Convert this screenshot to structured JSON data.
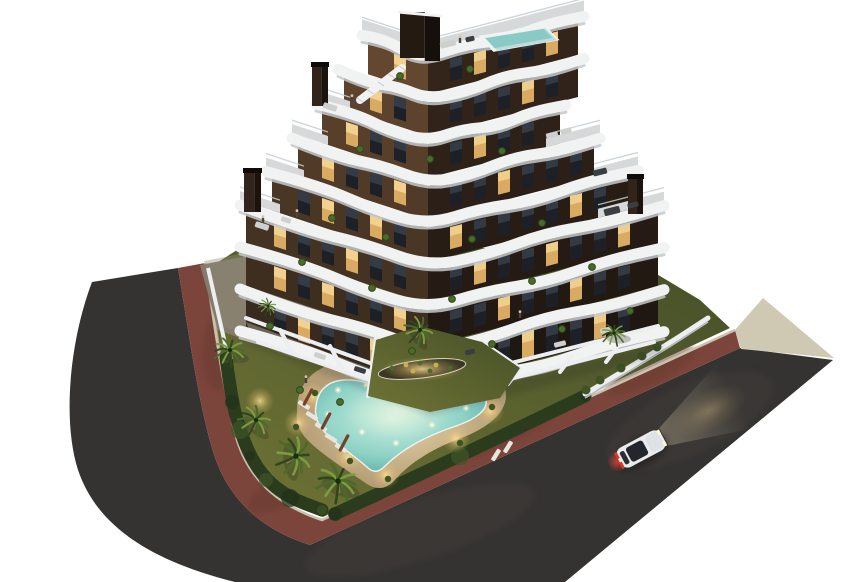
{
  "meta": {
    "kind": "architectural-dusk-render",
    "canvas": {
      "w": 850,
      "h": 582
    },
    "background": "#ffffff"
  },
  "palette": {
    "asphalt": "#353331",
    "asphalt_light": "#45413c",
    "road_edge": "#24221f",
    "bike": "#7c453b",
    "bike_dark": "#693a32",
    "curb": "#cbc2ae",
    "pale": "#cfc8b2",
    "lawn_light": "#6f7435",
    "lawn_dark": "#454f28",
    "hedge": "#2b3c1e",
    "hedge_dark": "#22311a",
    "hedge_light": "#3e5426",
    "deck_light": "#e2cfa6",
    "deck_dark": "#b49d75",
    "pool_light": "#c9efe0",
    "pool_mid": "#8fd2c6",
    "pool_deep": "#4f9f9b",
    "pool_rim": "#eaf5f0",
    "shrub": "#3f5524",
    "palm_dark": "#2e481c",
    "palm_mid": "#4b6b2a",
    "palm_light": "#7b9c42",
    "trunk": "#8a775a",
    "facade_l_top": "#63472f",
    "facade_l_bot": "#382a1e",
    "facade_r_top": "#34251a",
    "facade_r_bot": "#1f1712",
    "band": "#f1f2f2",
    "band_shadow": "#c6c9cb",
    "roof_deck": "#d6d8d9",
    "railing": "#c2cdd2",
    "win_dark": "#1d2026",
    "win_sheen": "#39414b",
    "win_lit": "#d9ab62",
    "win_lit_core": "#f4d795",
    "wall": "#eceeef",
    "wall_shade": "#b9bdbf",
    "terr_floor": "#6e695c",
    "chimney_face": "#33241b",
    "chimney_side": "#1c130d",
    "chimney_top": "#0f0b08",
    "bulk_face": "#241a12",
    "bulk_side": "#15100b",
    "roof_pool": "#9bd6d2",
    "roof_pool_deep": "#6fb8b4",
    "car_body": "#e9ebed",
    "car_glass": "#23272d",
    "car_tail": "#d8382a",
    "beam": "#f8e9c0",
    "shadow": "#1c1d22",
    "furn_light": "#cdd0cc",
    "furn_dark": "#3a3e43",
    "paving": "#837b6b",
    "paving_light": "#948b78",
    "soil": "#3a3823"
  },
  "scene": {
    "road": {
      "asphalt_path": "M92,282 C70,340 62,420 78,470 C95,520 140,558 235,582 L565,582 L833,360 L740,348 L310,545 Q232,520 212,448 C198,400 190,340 178,268 Z",
      "bike_path": "M178,268 L205,263 C216,335 224,395 237,440 Q255,498 322,520 L735,330 L740,348 L310,545 Q232,520 212,448 C198,400 190,340 178,268 Z",
      "curb_path": "M205,263 C216,335 224,395 237,440 Q255,498 322,520 L735,330",
      "pale_wedge": "M735,330 L763,298 L834,358 L741,349 Z",
      "bike_patches": [
        [
          300,
          480,
          60,
          18,
          -30
        ],
        [
          500,
          430,
          70,
          16,
          -25
        ],
        [
          650,
          370,
          50,
          14,
          -25
        ],
        [
          220,
          350,
          18,
          40,
          5
        ]
      ],
      "sheen_spots": [
        [
          690,
          420,
          90,
          34,
          -25
        ],
        [
          420,
          530,
          120,
          30,
          -18
        ]
      ]
    },
    "property": {
      "lawn_path": "M209,268 C218,335 226,395 239,438 Q256,494 323,517 L730,328 L700,300 L650,270 L610,248 L240,248 Z",
      "paving_path": "M200,265 L268,252 L355,318 L300,360 L218,330 Z",
      "courtyard_path": "M368,396 L376,340 L420,326 L482,342 L520,368 L500,398 L430,412 Z",
      "hedge_pts_a": [
        [
          226,
          358
        ],
        [
          232,
          402
        ],
        [
          240,
          430
        ],
        [
          250,
          456
        ],
        [
          266,
          480
        ],
        [
          290,
          498
        ],
        [
          322,
          510
        ]
      ],
      "hedge_pts_b": [
        [
          335,
          514
        ],
        [
          460,
          456
        ],
        [
          585,
          396
        ]
      ],
      "wall_pts": [
        [
          585,
          394
        ],
        [
          662,
          348
        ],
        [
          708,
          318
        ]
      ],
      "left_wall": [
        208,
        268,
        226,
        348
      ],
      "bed": {
        "cx": 422,
        "cy": 369,
        "rx": 44,
        "ry": 9,
        "rot": -7
      },
      "bed_plants": [
        [
          392,
          368
        ],
        [
          406,
          365
        ],
        [
          420,
          363
        ],
        [
          436,
          365
        ],
        [
          450,
          368
        ],
        [
          413,
          371
        ],
        [
          430,
          371
        ]
      ],
      "bushes": [
        [
          600,
          380
        ],
        [
          621,
          368
        ],
        [
          642,
          356
        ],
        [
          657,
          347
        ],
        [
          586,
          390
        ]
      ]
    },
    "pool": {
      "group_offset": [
        -2,
        -9
      ],
      "deck_path": "M299,421 C298,393 316,375 344,371 C369,367 389,375 398,384 Q402,388 406,384 C418,372 442,367 462,369 C488,371 507,383 508,403 C509,421 491,436 466,446 C438,456 413,470 395,491 Q383,502 369,493 C349,479 319,461 306,445 Q297,433 299,421 Z",
      "water_path": "M318,415 C320,398 331,390 346,389 C363,388 378,394 388,403 Q393,408 398,403 C409,393 431,388 449,389 C467,390 485,398 488,409 C490,419 478,428 458,435 C431,444 406,456 386,476 Q378,484 370,477 C355,463 331,449 322,435 Q316,425 318,415 Z",
      "lights": [
        [
          340,
          399
        ],
        [
          368,
          394
        ],
        [
          428,
          393
        ],
        [
          462,
          400
        ],
        [
          468,
          417
        ],
        [
          434,
          434
        ],
        [
          398,
          452
        ],
        [
          364,
          441
        ],
        [
          330,
          423
        ]
      ],
      "deck_glows": [
        [
          315,
          405
        ],
        [
          300,
          432
        ],
        [
          350,
          466
        ],
        [
          388,
          484
        ],
        [
          458,
          448
        ],
        [
          492,
          420
        ],
        [
          478,
          398
        ],
        [
          262,
          410
        ]
      ],
      "shrubs": [
        [
          317,
          402
        ],
        [
          298,
          436
        ],
        [
          352,
          470
        ],
        [
          390,
          488
        ],
        [
          462,
          452
        ],
        [
          494,
          416
        ],
        [
          480,
          394
        ]
      ],
      "loungers": [
        [
          306,
          414,
          32
        ],
        [
          314,
          425,
          32
        ],
        [
          323,
          436,
          32
        ],
        [
          333,
          447,
          32
        ],
        [
          343,
          457,
          32
        ],
        [
          498,
          464,
          -58
        ],
        [
          510,
          456,
          -58
        ]
      ],
      "umbrellas": [
        [
          310,
          406,
          118
        ],
        [
          328,
          430,
          118
        ],
        [
          346,
          452,
          118
        ]
      ]
    },
    "building": {
      "corner": 428,
      "slope_left": 0.33,
      "slope_right": 0.26,
      "band_w": 11,
      "bands": [
        {
          "y": 393,
          "xl": 240,
          "xr": 664
        },
        {
          "y": 351,
          "xl": 240,
          "xr": 664
        },
        {
          "y": 309,
          "xl": 240,
          "xr": 664
        },
        {
          "y": 267,
          "xl": 240,
          "xr": 664,
          "terr_l": [
            240,
            280
          ],
          "terr_r": [
            598,
            664
          ]
        },
        {
          "y": 225,
          "xl": 266,
          "xr": 638,
          "terr_l": [
            266,
            304
          ],
          "terr_r": [
            594,
            638
          ]
        },
        {
          "y": 183,
          "xl": 292,
          "xr": 600,
          "terr_l": [
            292,
            328
          ],
          "terr_r": [
            546,
            600
          ]
        },
        {
          "y": 141,
          "xl": 316,
          "xr": 566,
          "terr_l": [
            316,
            350
          ]
        },
        {
          "y": 99,
          "xl": 338,
          "xr": 584
        },
        {
          "y": 57,
          "xl": 362,
          "xr": 584,
          "roof": true
        }
      ],
      "levels": [
        {
          "lit_l": [
            1,
            4
          ],
          "lit_r": [
            0,
            3,
            6
          ]
        },
        {
          "lit_l": [
            0,
            3,
            5
          ],
          "lit_r": [
            2,
            5,
            8
          ]
        },
        {
          "lit_l": [
            2,
            5
          ],
          "lit_r": [
            1,
            4,
            7
          ]
        },
        {
          "lit_l": [
            1,
            3
          ],
          "lit_r": [
            0,
            5
          ]
        },
        {
          "lit_l": [
            0,
            3
          ],
          "lit_r": [
            2,
            6
          ]
        },
        {
          "lit_l": [
            2
          ],
          "lit_r": [
            1,
            4
          ]
        },
        {
          "lit_l": [
            1,
            3
          ],
          "lit_r": [
            3,
            5
          ]
        },
        {
          "lit_l": [
            0,
            2
          ],
          "lit_r": [
            1,
            4
          ]
        }
      ],
      "chimneys": [
        [
          244,
          172,
          17,
          40
        ],
        [
          312,
          66,
          16,
          40
        ],
        [
          628,
          178,
          15,
          36
        ]
      ],
      "bulkhead": [
        400,
        12,
        40,
        46
      ],
      "stairs": [
        360,
        100,
        402,
        68
      ],
      "roof_pool": "M482,37 L544,27 L556,39 L494,50 Z",
      "ground_walls": [
        [
          246,
          318,
          428,
          384
        ],
        [
          428,
          384,
          658,
          326
        ],
        [
          258,
          342,
          428,
          400
        ],
        [
          428,
          400,
          654,
          342
        ],
        [
          280,
          330,
          292,
          352
        ],
        [
          330,
          346,
          342,
          368
        ],
        [
          380,
          362,
          392,
          384
        ],
        [
          468,
          380,
          456,
          396
        ],
        [
          520,
          368,
          508,
          384
        ],
        [
          572,
          356,
          560,
          372
        ],
        [
          618,
          346,
          606,
          362
        ],
        [
          368,
          396,
          376,
          338
        ],
        [
          482,
          342,
          520,
          368
        ]
      ],
      "terrace_floor": "M246,322 L428,390 L658,330 L652,344 L428,404 L252,336 Z",
      "tufts": [
        [
          302,
          262
        ],
        [
          372,
          288
        ],
        [
          452,
          299
        ],
        [
          532,
          281
        ],
        [
          592,
          267
        ],
        [
          270,
          326
        ],
        [
          412,
          351
        ],
        [
          492,
          344
        ],
        [
          562,
          329
        ],
        [
          630,
          311
        ],
        [
          332,
          218
        ],
        [
          386,
          237
        ],
        [
          472,
          239
        ],
        [
          542,
          223
        ],
        [
          360,
          149
        ],
        [
          430,
          159
        ],
        [
          502,
          151
        ],
        [
          400,
          76
        ],
        [
          470,
          69
        ],
        [
          300,
          390
        ],
        [
          340,
          402
        ]
      ],
      "furniture": [
        [
          262,
          226,
          14,
          6,
          18,
          "l"
        ],
        [
          286,
          220,
          10,
          5,
          18,
          "l"
        ],
        [
          612,
          211,
          16,
          7,
          -14,
          "d"
        ],
        [
          633,
          205,
          11,
          5,
          -14,
          "d"
        ],
        [
          600,
          172,
          14,
          6,
          -14,
          "d"
        ],
        [
          552,
          135,
          12,
          5,
          -14,
          "l"
        ],
        [
          566,
          131,
          11,
          5,
          -14,
          "l"
        ],
        [
          330,
          107,
          14,
          6,
          18,
          "l"
        ],
        [
          448,
          44,
          16,
          6,
          -14,
          "l"
        ],
        [
          470,
          39,
          9,
          5,
          -14,
          "d"
        ],
        [
          560,
          344,
          12,
          5,
          -14,
          "l"
        ],
        [
          606,
          330,
          12,
          5,
          -14,
          "l"
        ],
        [
          470,
          352,
          10,
          5,
          -14,
          "d"
        ],
        [
          320,
          356,
          12,
          5,
          18,
          "l"
        ],
        [
          360,
          370,
          12,
          5,
          18,
          "d"
        ]
      ],
      "people": [
        [
          263,
          222
        ],
        [
          297,
          216
        ],
        [
          352,
          101
        ],
        [
          460,
          42
        ],
        [
          306,
          382
        ],
        [
          520,
          317
        ]
      ]
    },
    "palms": [
      [
        230,
        350,
        0.95,
        10
      ],
      [
        256,
        420,
        1.0,
        40
      ],
      [
        296,
        456,
        1.2,
        80
      ],
      [
        338,
        481,
        1.25,
        20
      ],
      [
        420,
        330,
        0.9,
        55
      ],
      [
        614,
        333,
        0.75,
        0
      ],
      [
        268,
        306,
        0.55,
        30
      ]
    ],
    "car": {
      "cx": 641,
      "cy": 449,
      "angle": -28
    }
  }
}
